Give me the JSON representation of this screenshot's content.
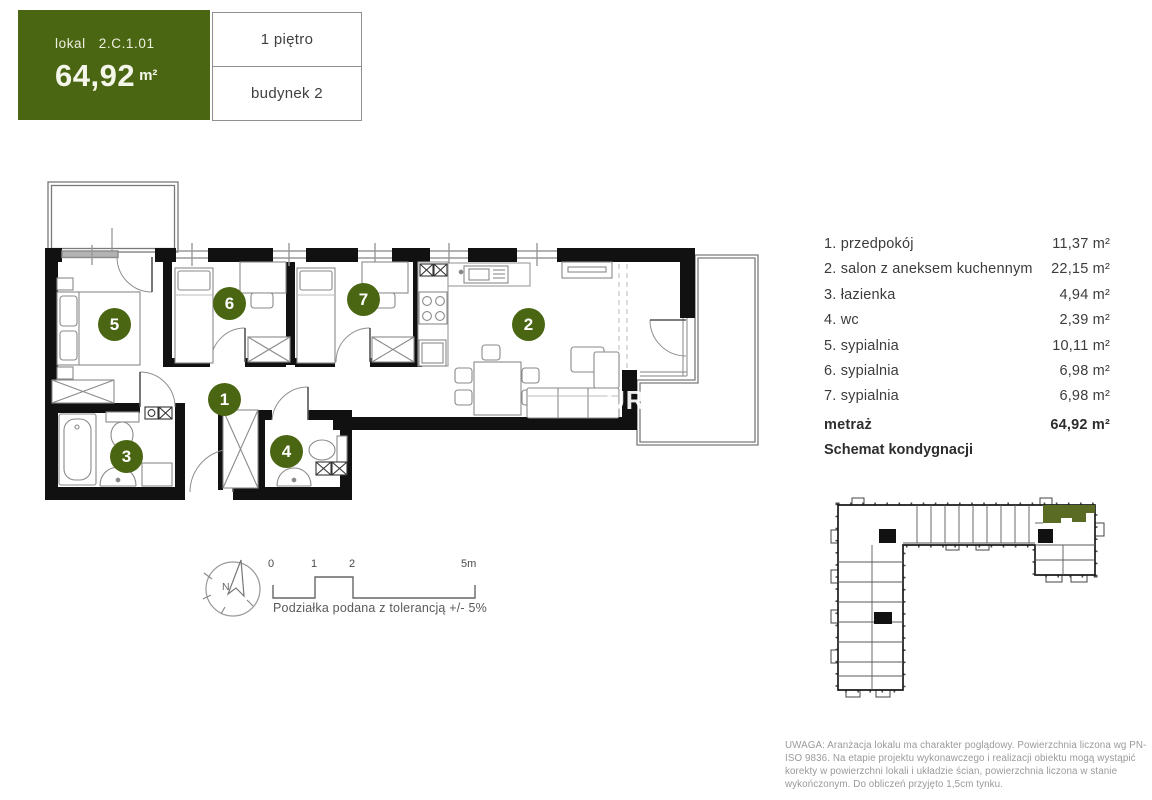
{
  "header": {
    "lokal_label": "lokal",
    "unit_number": "2.C.1.01",
    "area_value": "64,92",
    "area_unit": "m²",
    "floor": "1 piętro",
    "building": "budynek 2"
  },
  "rooms": [
    {
      "num": "1",
      "label": "1. przedpokój",
      "area": "11,37 m²"
    },
    {
      "num": "2",
      "label": "2. salon z aneksem kuchennym",
      "area": "22,15 m²"
    },
    {
      "num": "3",
      "label": "3. łazienka",
      "area": "4,94 m²"
    },
    {
      "num": "4",
      "label": "4. wc",
      "area": "2,39 m²"
    },
    {
      "num": "5",
      "label": "5. sypialnia",
      "area": "10,11 m²"
    },
    {
      "num": "6",
      "label": "6. sypialnia",
      "area": "6,98 m²"
    },
    {
      "num": "7",
      "label": "7. sypialnia",
      "area": "6,98 m²"
    }
  ],
  "summary": {
    "metraz_label": "metraż",
    "metraz_value": "64,92 m²",
    "schemat_label": "Schemat kondygnacji"
  },
  "scalebar": {
    "tick0": "0",
    "tick1": "1",
    "tick2": "2",
    "tick5": "5m",
    "caption": "Podziałka podana z tolerancją +/- 5%"
  },
  "compass": {
    "label": "N"
  },
  "watermark": {
    "text": "UR"
  },
  "disclaimer": {
    "text": "UWAGA: Aranżacja lokalu ma charakter poglądowy. Powierzchnia liczona wg PN-ISO 9836. Na etapie projektu wykonawczego i realizacji obiektu mogą wystąpić korekty w powierzchni lokali i układzie ścian, powierzchnia liczona w stanie wykończonym. Do obliczeń przyjęto 1,5cm tynku.",
    "colors_note": ""
  },
  "colors": {
    "brand_green": "#4a6613",
    "schematic_green": "#5a6b24"
  }
}
